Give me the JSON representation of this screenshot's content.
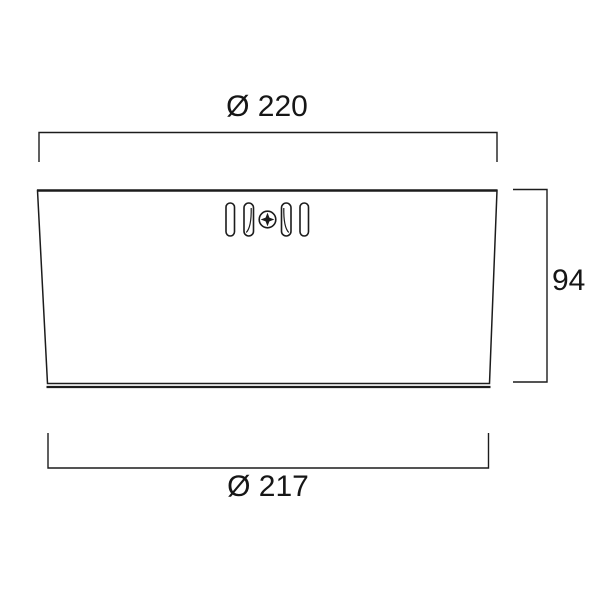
{
  "canvas": {
    "width": 600,
    "height": 600,
    "background": "#ffffff"
  },
  "style": {
    "line_color": "#1c1c1c",
    "text_color": "#161616"
  },
  "drawing": {
    "kind": "technical dimension drawing",
    "dimensions": {
      "top_width": {
        "label": "Ø 220",
        "value": 220
      },
      "side_height": {
        "label": "94",
        "value": 94
      },
      "bottom_width": {
        "label": "Ø 217",
        "value": 217
      }
    },
    "features": {
      "vent_slot_count": 4,
      "fastener_icon": "phillips-screw-icon"
    }
  }
}
